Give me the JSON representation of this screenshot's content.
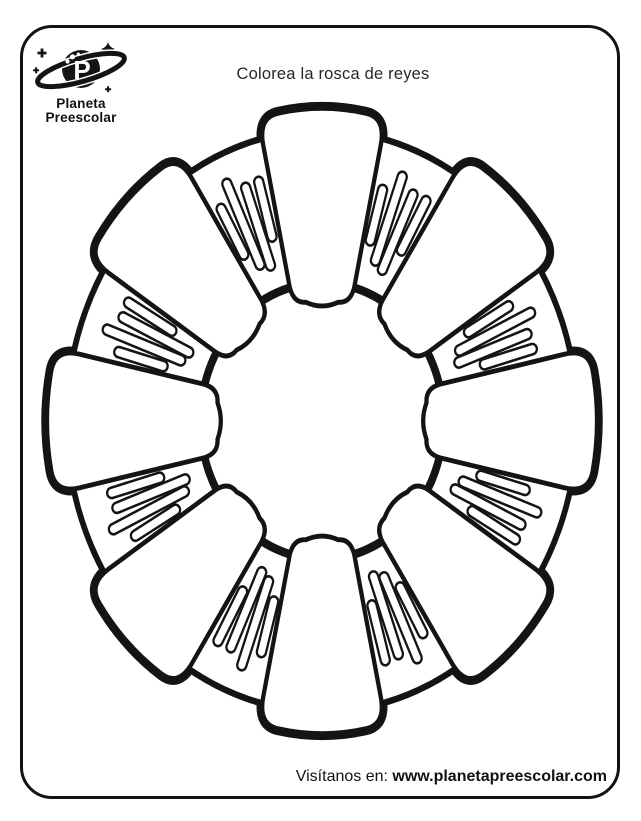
{
  "page": {
    "title": "Colorea la rosca de reyes"
  },
  "logo": {
    "brand_line1": "Planeta",
    "brand_line2": "Preescolar"
  },
  "footer": {
    "label": "Visítanos en: ",
    "url": "www.planetapreescolar.com"
  },
  "illustration": {
    "name": "rosca-de-reyes-coloring-outline",
    "colors": {
      "ink": "#141414",
      "paper": "#ffffff"
    },
    "ring": {
      "cx": 304,
      "cy": 326,
      "scale_x": 0.95,
      "scale_y": 1.08,
      "outer_r": 266,
      "inner_r": 128
    },
    "bun_count": 8,
    "bun_angle_step": 45,
    "stripe_group_count": 8,
    "stripe_angle_offset": 22.5,
    "stripes_per_group": 4,
    "stripe_pattern": [
      {
        "x": -20,
        "len": 58,
        "r": 198,
        "tilt": -7
      },
      {
        "x": -6.7,
        "len": 92,
        "r": 200,
        "tilt": -2.5
      },
      {
        "x": 6.7,
        "len": 86,
        "r": 192,
        "tilt": 2.5
      },
      {
        "x": 20,
        "len": 62,
        "r": 204,
        "tilt": 7
      }
    ],
    "stroke": {
      "silhouette": 12,
      "inner_hole": 8,
      "bun": 4.5,
      "stripe": 2.4
    },
    "stripe_width": 9.6
  }
}
